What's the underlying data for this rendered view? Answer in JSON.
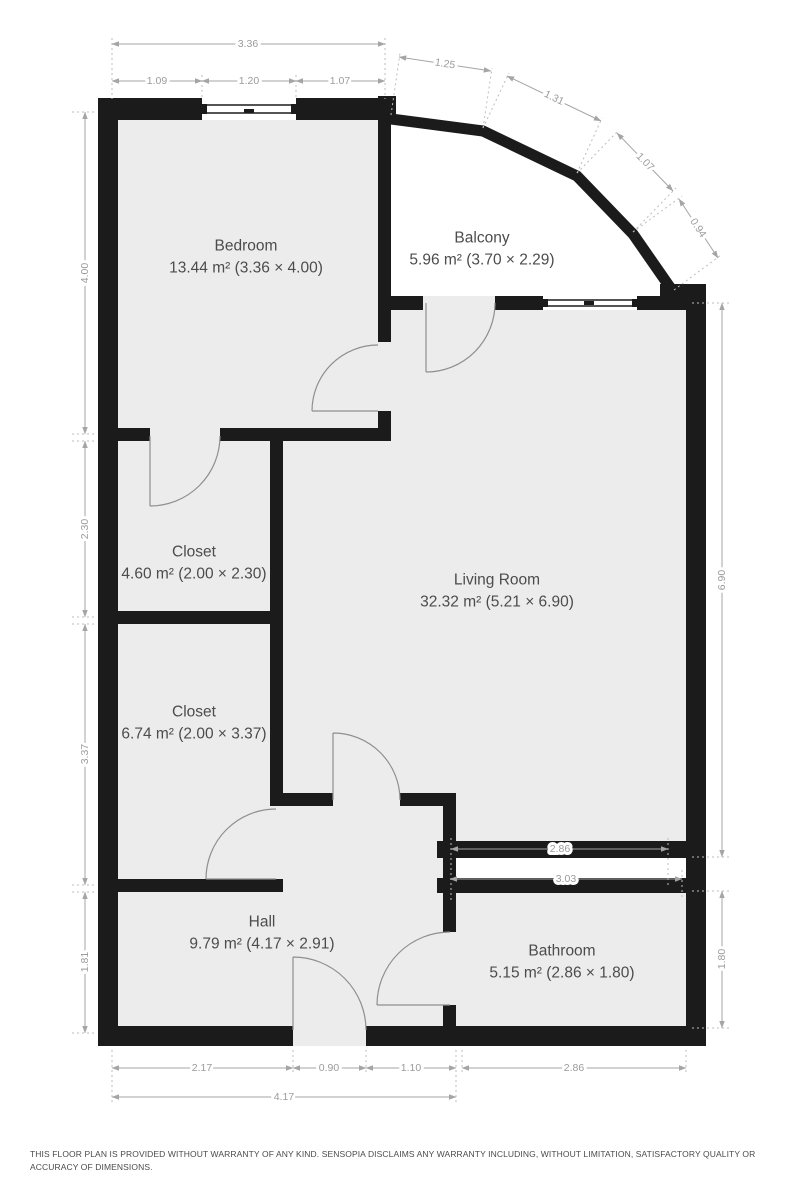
{
  "rooms": {
    "bedroom": {
      "label": "Bedroom",
      "area": "13.44 m² (3.36 × 4.00)"
    },
    "balcony": {
      "label": "Balcony",
      "area": "5.96 m² (3.70 × 2.29)"
    },
    "closet1": {
      "label": "Closet",
      "area": "4.60 m² (2.00 × 2.30)"
    },
    "closet2": {
      "label": "Closet",
      "area": "6.74 m² (2.00 × 3.37)"
    },
    "living": {
      "label": "Living Room",
      "area": "32.32 m² (5.21 × 6.90)"
    },
    "hall": {
      "label": "Hall",
      "area": "9.79 m² (4.17 × 2.91)"
    },
    "bathroom": {
      "label": "Bathroom",
      "area": "5.15 m² (2.86 × 1.80)"
    }
  },
  "dims": {
    "top_total": "3.36",
    "top_left": "1.09",
    "top_window": "1.20",
    "top_right": "1.07",
    "balcony_1": "1.25",
    "balcony_2": "1.31",
    "balcony_3": "1.07",
    "balcony_4": "0.94",
    "left_bedroom": "4.00",
    "left_closet_top": "2.30",
    "left_closet_bottom": "3.37",
    "left_hall": "1.81",
    "right_living": "6.90",
    "right_bathroom": "1.80",
    "living_window_top": "2.86",
    "living_window_bottom": "3.03",
    "bottom_hall_left": "2.17",
    "bottom_door": "0.90",
    "bottom_hall_right": "1.10",
    "bottom_bathroom": "2.86",
    "bottom_hall_total": "4.17"
  },
  "colors": {
    "wall": "#1b1b1b",
    "floor": "#ececec",
    "dimension": "#9b9b9b"
  },
  "footer": {
    "disclaimer": "THIS FLOOR PLAN IS PROVIDED WITHOUT WARRANTY OF ANY KIND. SENSOPIA DISCLAIMS ANY WARRANTY INCLUDING, WITHOUT LIMITATION, SATISFACTORY QUALITY OR ACCURACY OF DIMENSIONS."
  }
}
